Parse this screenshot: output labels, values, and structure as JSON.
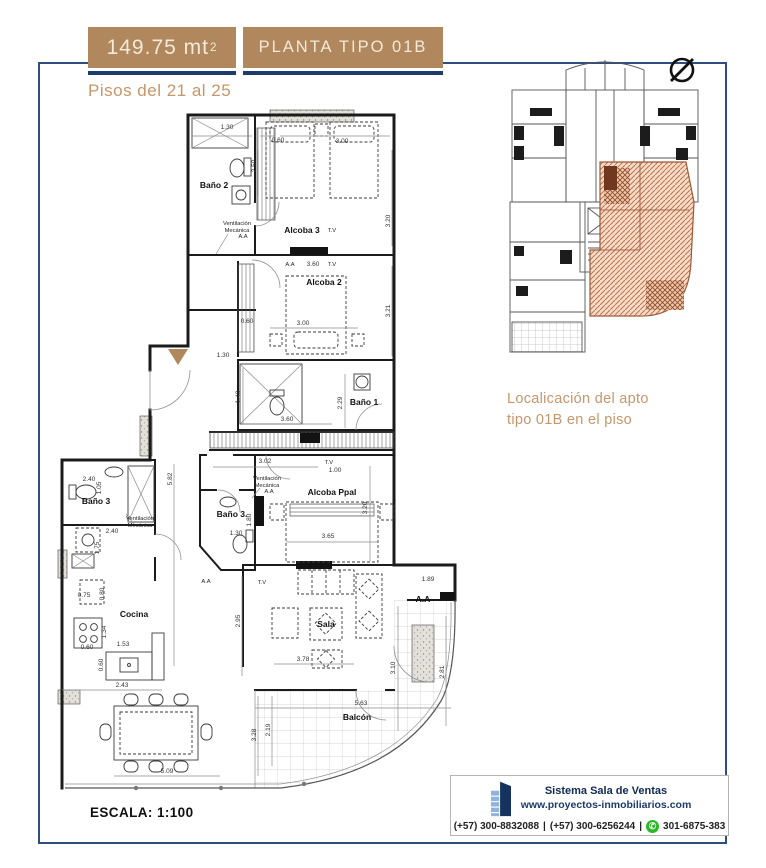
{
  "header": {
    "area_value": "149.75 mt",
    "area_exp": "2",
    "type_label": "PLANTA TIPO 01B",
    "floors_label": "Pisos del 21 al 25"
  },
  "key_plan": {
    "caption1": "Localicación del apto",
    "caption2": "tipo 01B en el piso"
  },
  "plan": {
    "scale_label": "ESCALA: 1:100",
    "rooms": {
      "bano2": "Baño 2",
      "alcoba3": "Alcoba 3",
      "alcoba2": "Alcoba 2",
      "bano1": "Baño 1",
      "alcoba_ppal": "Alcoba Ppal",
      "bano3_mid": "Baño 3.",
      "bano3_izq": "Baño 3",
      "cocina": "Cocina",
      "sala": "Sala",
      "aa_zone": "A.A",
      "balcon": "Balcón"
    },
    "notes": {
      "vent1": "Ventilación",
      "vent2": "Mecánica"
    },
    "tags": {
      "aa": "A.A",
      "tv": "T.V"
    },
    "dims": {
      "b2_top": "1.30",
      "b2_wc": "2.50",
      "a3_left": "0.60",
      "a3_top": "3.00",
      "a3_right": "3.20",
      "a3_bottom": "3.60",
      "a2_right": "3.21",
      "a2_left": "0.60",
      "a2_bed": "3.00",
      "b1_left": "1.40",
      "b1_bottom": "3.60",
      "b1_right": "2.29",
      "entry_top": "1.30",
      "hall": "3.02",
      "hall_tv": "1.00",
      "pp_right": "3.20",
      "pp_bed": "3.65",
      "b3m_w": "1.30",
      "b3m_h": "1.80",
      "izq_total": "5.82",
      "b3i_top": "2.40",
      "b3i_h": "1.05",
      "lav_w": "2.40",
      "lav_h": "1.75",
      "coc_nev": "0.75",
      "coc_nev_h": "0.80",
      "coc_est_h": "1.34",
      "coc_est_w": "0.60",
      "coc_mes": "1.53",
      "coc_mes_h": "0.60",
      "coc_total": "2.43",
      "sala_left": "2.95",
      "sala_bottom": "3.78",
      "aa_top": "1.89",
      "aa_left": "3.10",
      "aa_right": "2.81",
      "balcon_top": "5.63",
      "balcon_left": "3.28",
      "balcon_left2": "2.19",
      "comedor": "5.09"
    }
  },
  "footer": {
    "brand": "Sistema Sala de Ventas",
    "website": "www.proyectos-inmobiliarios.com",
    "phone1": "(+57) 300-8832088",
    "sep1": "|",
    "phone2": "(+57) 300-6256244",
    "sep2": "|",
    "phone3": "301-6875-383"
  },
  "colors": {
    "accent_tan": "#b1875d",
    "tan_text": "#c6966b",
    "navy": "#1d3c6c",
    "frame_navy": "#2e4d80",
    "hatch_salmon": "#c0714a",
    "whatsapp_green": "#2bb826"
  }
}
